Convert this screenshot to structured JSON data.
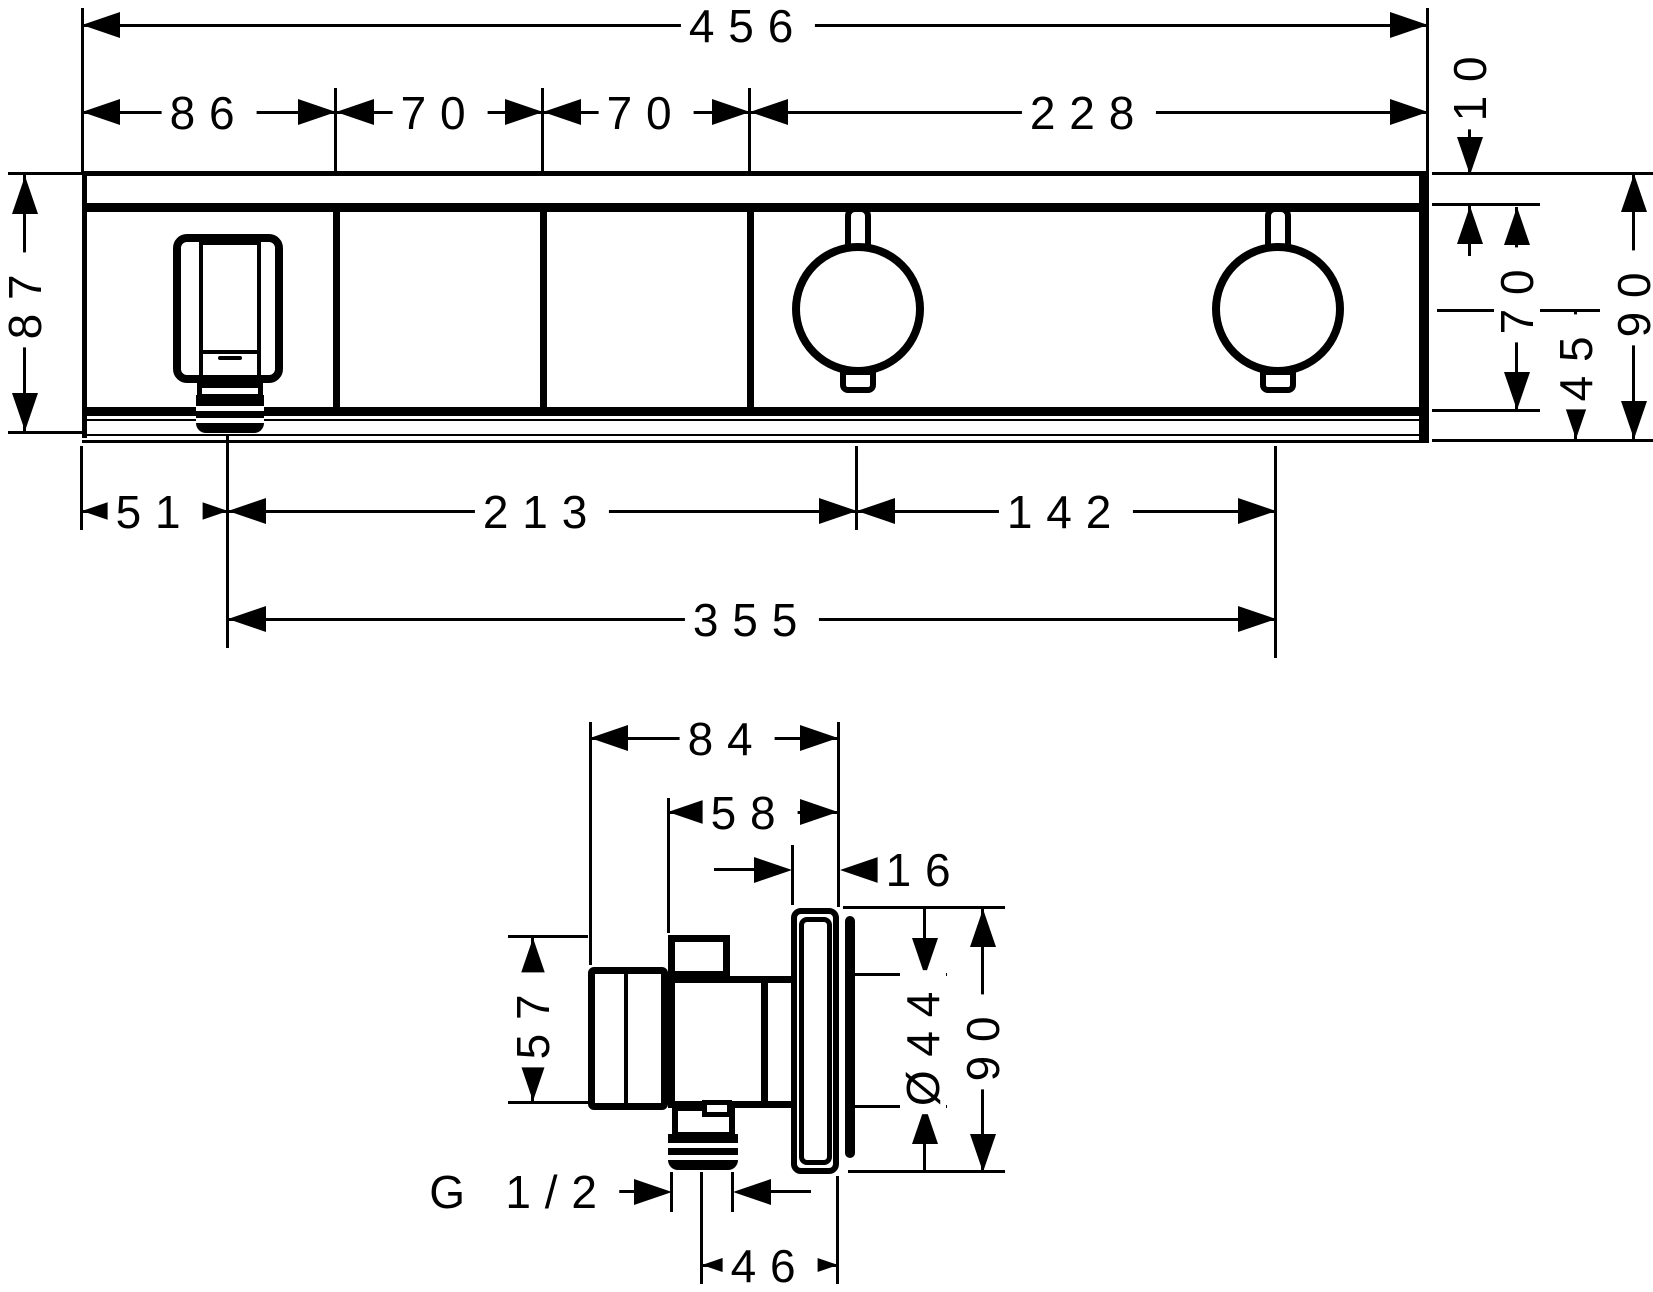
{
  "drawing": {
    "kind": "technical-dimension-drawing",
    "units": "mm",
    "front_view": {
      "total_width": "456",
      "segment_a": "86",
      "segment_b": "70",
      "segment_c": "70",
      "segment_d": "228",
      "top_strip": "10",
      "overall_height": "87",
      "inner_height": "70",
      "knob_axis_to_bottom": "45",
      "end_height": "90",
      "outlet_offset": "51",
      "outlet_to_first_knob": "213",
      "knob_spacing": "142",
      "outlet_to_second_knob": "355"
    },
    "side_view": {
      "overall_depth": "84",
      "body_depth": "58",
      "escutcheon_depth": "16",
      "body_height": "57",
      "escutcheon_diameter": "Ø44",
      "escutcheon_height": "90",
      "connection_thread": "G 1/2",
      "axis_to_wall_plate": "46"
    }
  },
  "colors": {
    "line": "#000000",
    "background": "#ffffff"
  }
}
